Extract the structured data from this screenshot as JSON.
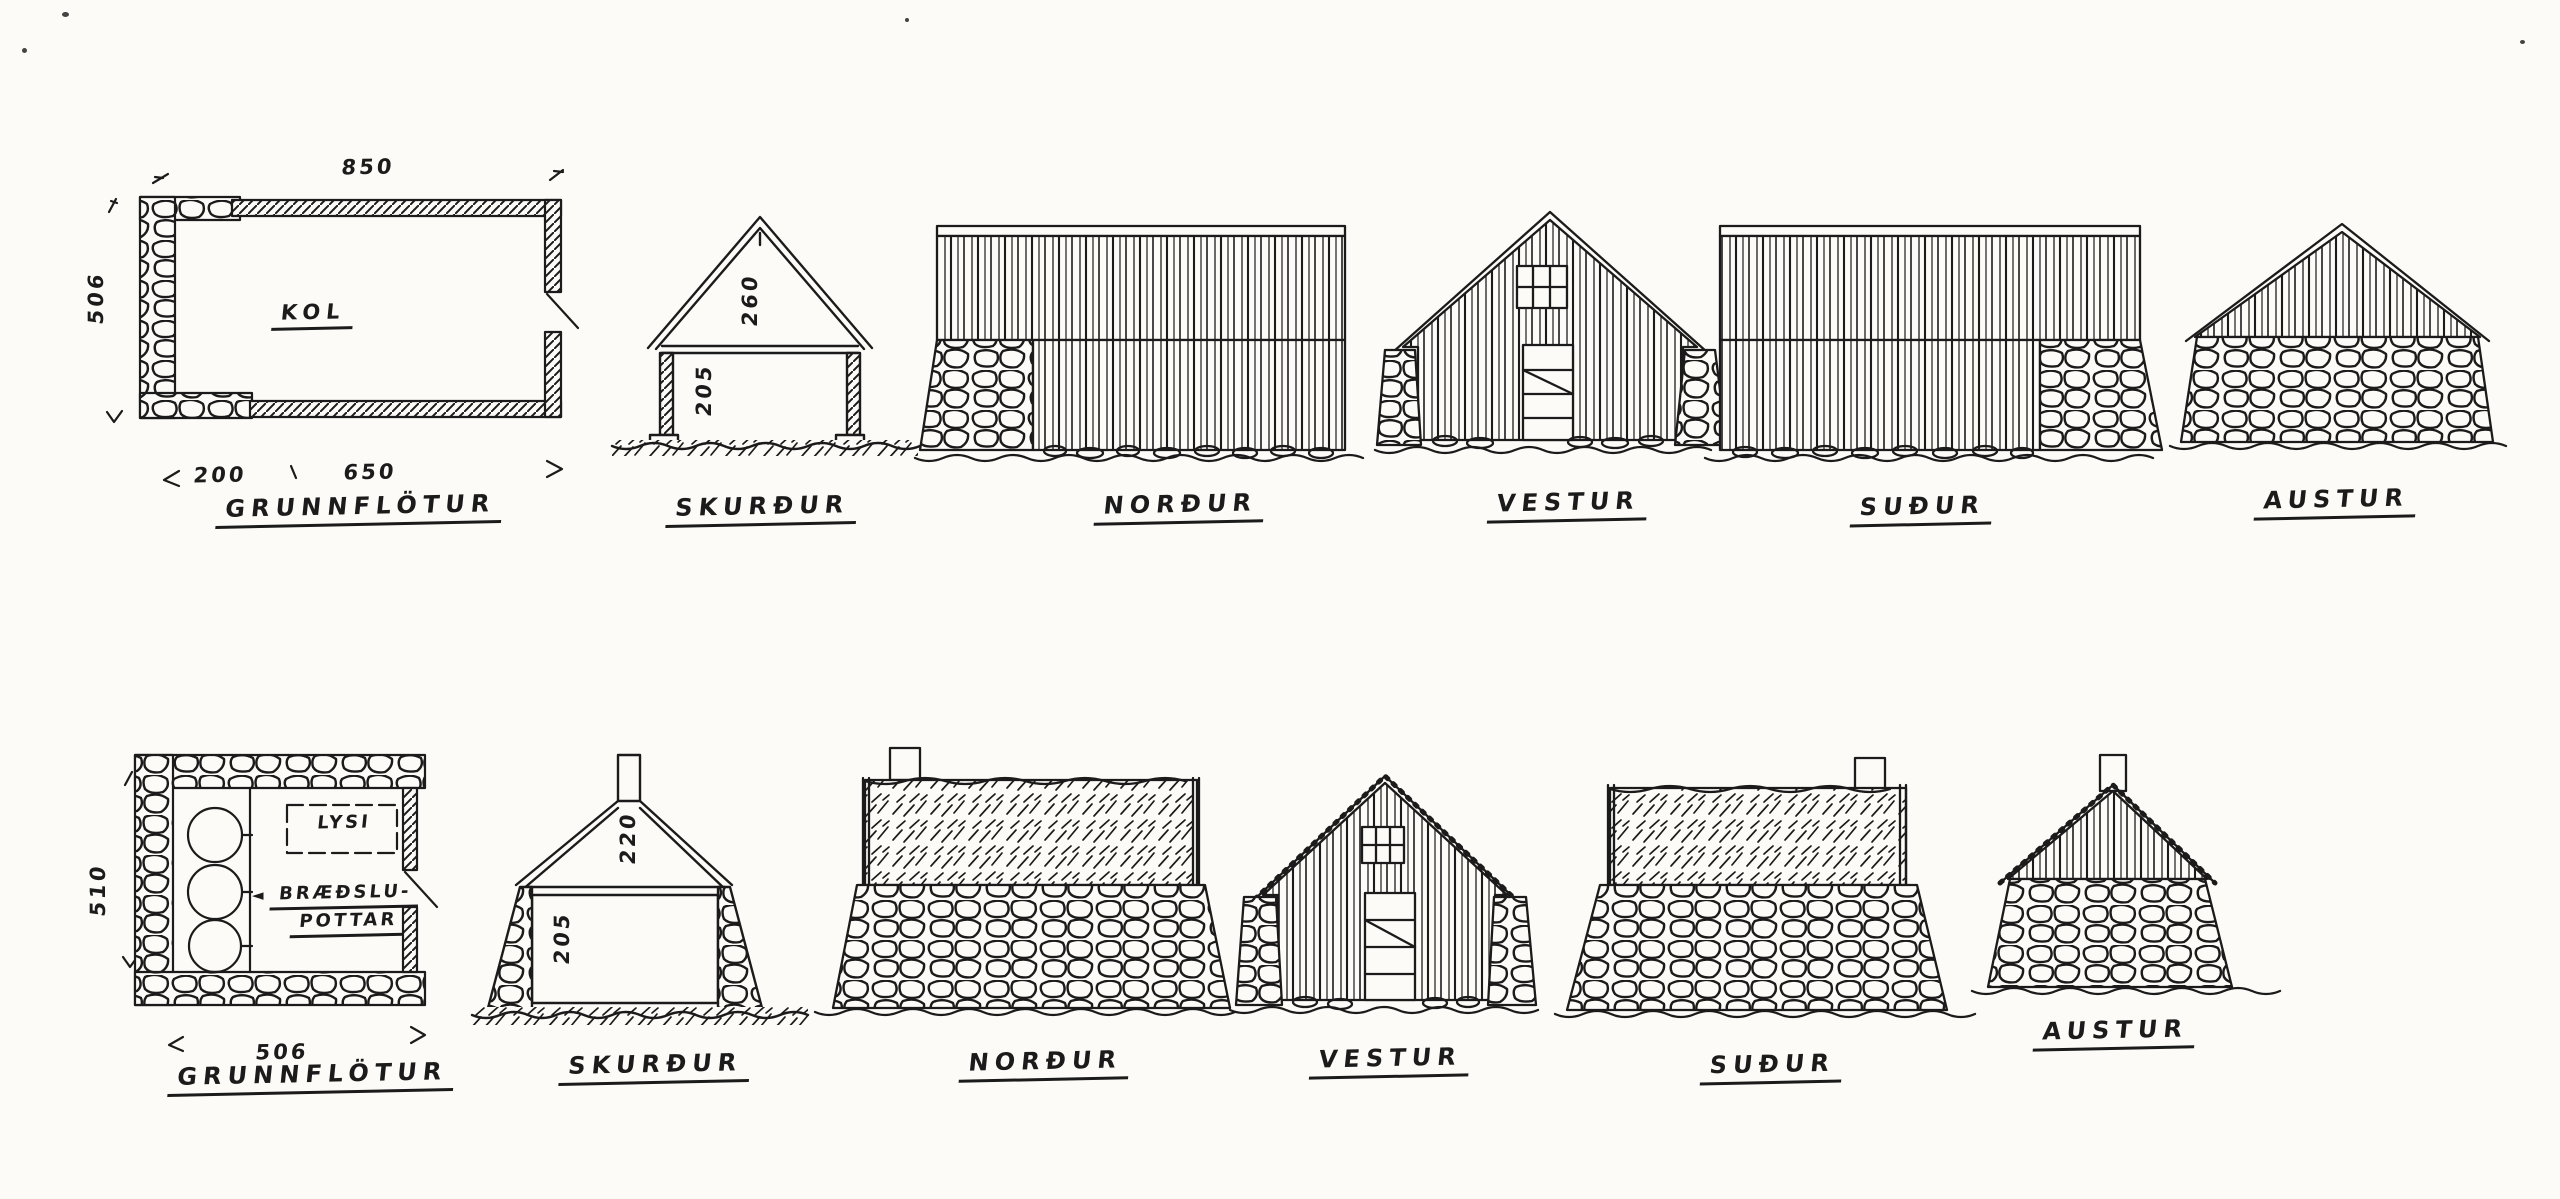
{
  "palette": {
    "paper": "#fcfbf7",
    "ink": "#1b1b1b"
  },
  "icons": {
    "pots_arrow": "◄"
  },
  "row1": {
    "plan": {
      "title": "GRUNNFLÖTUR",
      "room": "KOL",
      "dim_top": "850",
      "dim_left": "506",
      "dim_bottom_a": "200",
      "dim_bottom_b": "650"
    },
    "section": {
      "title": "SKURÐUR",
      "dim_ridge": "260",
      "dim_wall": "205"
    },
    "north": {
      "title": "NORÐUR"
    },
    "west": {
      "title": "VESTUR"
    },
    "south": {
      "title": "SUÐUR"
    },
    "east": {
      "title": "AUSTUR"
    }
  },
  "row2": {
    "plan": {
      "title": "GRUNNFLÖTUR",
      "room": "LYSI",
      "pots_line1": "BRÆÐSLU-",
      "pots_line2": "POTTAR",
      "dim_left": "510",
      "dim_bottom": "506"
    },
    "section": {
      "title": "SKURÐUR",
      "dim_ridge": "220",
      "dim_wall": "205"
    },
    "north": {
      "title": "NORÐUR"
    },
    "west": {
      "title": "VESTUR"
    },
    "south": {
      "title": "SUÐUR"
    },
    "east": {
      "title": "AUSTUR"
    }
  }
}
